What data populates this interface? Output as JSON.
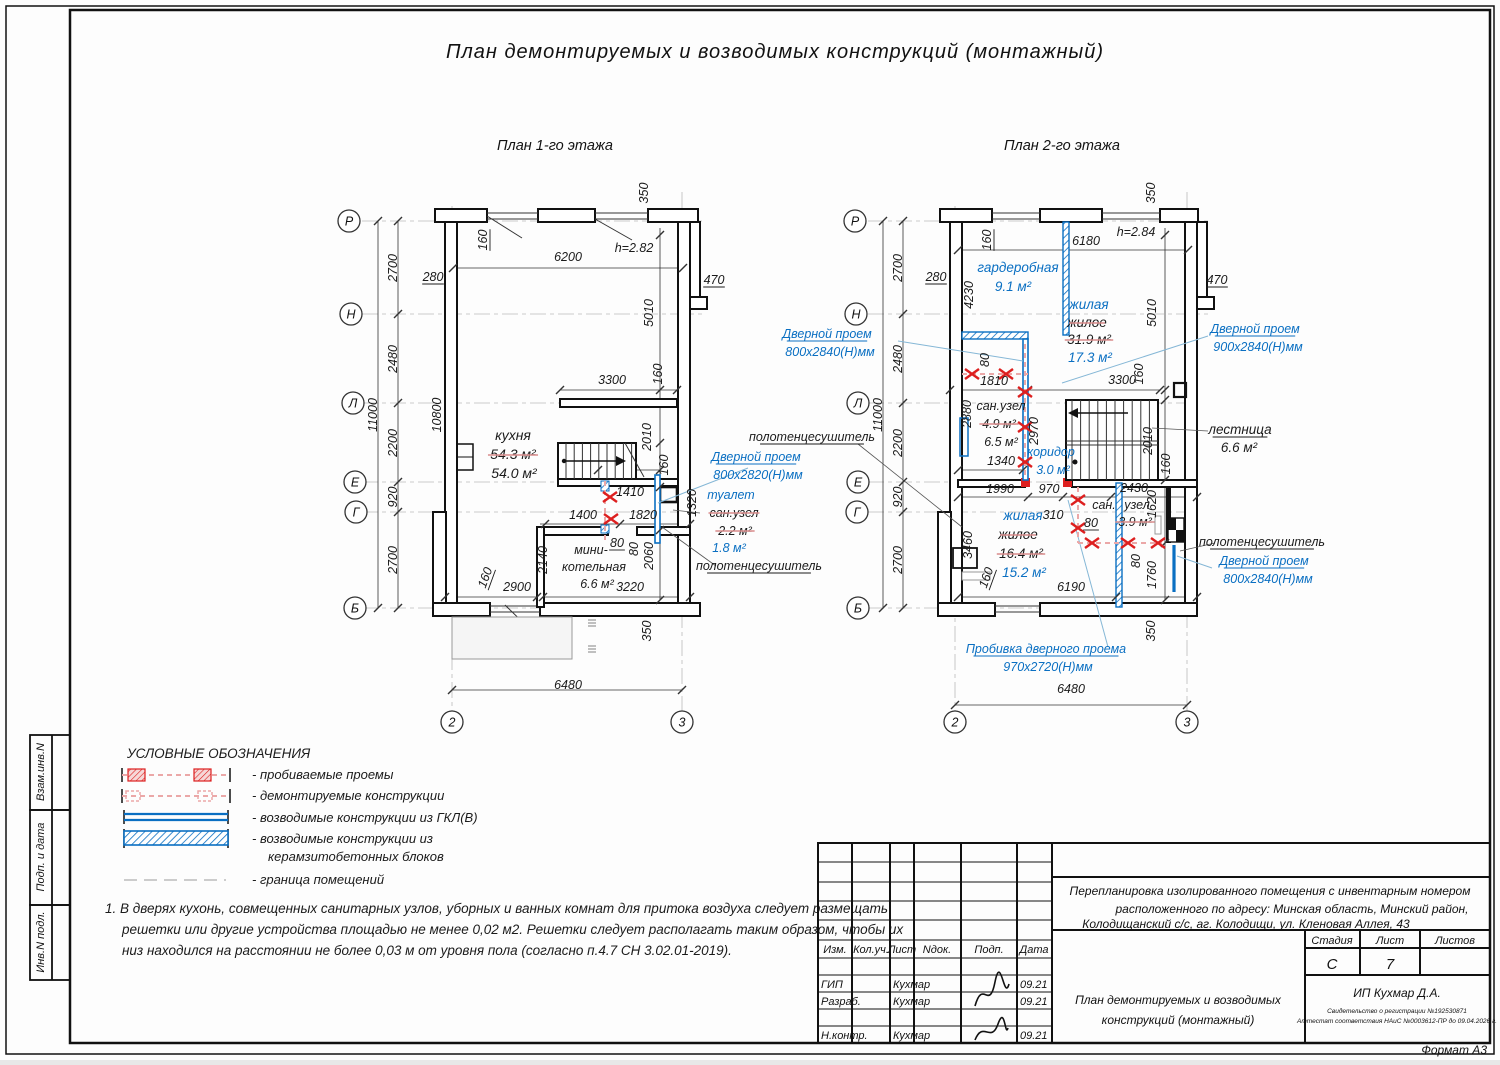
{
  "title": "План демонтируемых и возводимых конструкций (монтажный)",
  "colors": {
    "accent_blue": "#0a6fc2",
    "mark_red": "#dd1f1f",
    "strike_pink": "#d98b8b"
  },
  "plan1": {
    "subtitle": "План 1-го этажа",
    "axes": [
      {
        "t": "Р",
        "x": 349,
        "y": 221
      },
      {
        "t": "Н",
        "x": 351,
        "y": 314
      },
      {
        "t": "Л",
        "x": 353,
        "y": 403
      },
      {
        "t": "Е",
        "x": 355,
        "y": 482
      },
      {
        "t": "Г",
        "x": 356,
        "y": 512
      },
      {
        "t": "Б",
        "x": 355,
        "y": 608
      },
      {
        "t": "2",
        "x": 452,
        "y": 722
      },
      {
        "t": "3",
        "x": 682,
        "y": 722
      }
    ],
    "labels": [
      {
        "t": "350",
        "x": 648,
        "y": 193,
        "r": -90
      },
      {
        "t": "160",
        "x": 487,
        "y": 240,
        "r": -90,
        "u": 1
      },
      {
        "t": "6200",
        "x": 568,
        "y": 261
      },
      {
        "t": "h=2.82",
        "x": 634,
        "y": 252
      },
      {
        "t": "280",
        "x": 433,
        "y": 281,
        "u": 1
      },
      {
        "t": "470",
        "x": 714,
        "y": 284,
        "u": 1
      },
      {
        "t": "2700",
        "x": 397,
        "y": 268,
        "r": -90
      },
      {
        "t": "2480",
        "x": 397,
        "y": 359,
        "r": -90
      },
      {
        "t": "11000",
        "x": 377,
        "y": 415,
        "r": -90
      },
      {
        "t": "2200",
        "x": 397,
        "y": 443,
        "r": -90
      },
      {
        "t": "920",
        "x": 397,
        "y": 497,
        "r": -90
      },
      {
        "t": "2700",
        "x": 397,
        "y": 560,
        "r": -90
      },
      {
        "t": "5010",
        "x": 653,
        "y": 313,
        "r": -90
      },
      {
        "t": "10800",
        "x": 441,
        "y": 415,
        "r": -90
      },
      {
        "t": "3300",
        "x": 612,
        "y": 384
      },
      {
        "t": "160",
        "x": 662,
        "y": 374,
        "r": -90
      },
      {
        "t": "кухня",
        "x": 513,
        "y": 440,
        "fs": 14
      },
      {
        "t": "54.3 м²",
        "x": 513,
        "y": 459,
        "s": 1,
        "fs": 14
      },
      {
        "t": "54.0 м²",
        "x": 514,
        "y": 478,
        "fs": 14
      },
      {
        "t": "2010",
        "x": 651,
        "y": 437,
        "r": -90
      },
      {
        "t": "160",
        "x": 668,
        "y": 465,
        "r": -90
      },
      {
        "t": "1410",
        "x": 630,
        "y": 496
      },
      {
        "t": "1400",
        "x": 583,
        "y": 519
      },
      {
        "t": "1820",
        "x": 643,
        "y": 519
      },
      {
        "t": "1320",
        "x": 696,
        "y": 503,
        "r": -90
      },
      {
        "t": "80",
        "x": 617,
        "y": 547,
        "u": 1
      },
      {
        "t": "80",
        "x": 638,
        "y": 549,
        "r": -90
      },
      {
        "t": "2140",
        "x": 547,
        "y": 560,
        "r": -90
      },
      {
        "t": "2060",
        "x": 653,
        "y": 556,
        "r": -90
      },
      {
        "t": "мини-",
        "x": 591,
        "y": 554
      },
      {
        "t": "котельная",
        "x": 594,
        "y": 571
      },
      {
        "t": "6.6 м²",
        "x": 597,
        "y": 588
      },
      {
        "t": "3220",
        "x": 630,
        "y": 591
      },
      {
        "t": "2900",
        "x": 517,
        "y": 591
      },
      {
        "t": "160",
        "x": 489,
        "y": 579,
        "r": -70,
        "u": 1
      },
      {
        "t": "350",
        "x": 651,
        "y": 631,
        "r": -90
      },
      {
        "t": "6480",
        "x": 568,
        "y": 689
      },
      {
        "t": "Дверной проем",
        "x": 756,
        "y": 461,
        "c": "b",
        "u": 1
      },
      {
        "t": "800x2820(Н)мм",
        "x": 758,
        "y": 479,
        "c": "b"
      },
      {
        "t": "туалет",
        "x": 731,
        "y": 499,
        "c": "b"
      },
      {
        "t": "сан.узел",
        "x": 734,
        "y": 517,
        "s": 1
      },
      {
        "t": "2.2 м²",
        "x": 735,
        "y": 535,
        "s": 1
      },
      {
        "t": "1.8 м²",
        "x": 729,
        "y": 552,
        "c": "b"
      },
      {
        "t": "полотенцесушитель",
        "x": 759,
        "y": 570,
        "u": 1
      }
    ]
  },
  "plan2": {
    "subtitle": "План 2-го этажа",
    "axes": [
      {
        "t": "Р",
        "x": 855,
        "y": 221
      },
      {
        "t": "Н",
        "x": 856,
        "y": 314
      },
      {
        "t": "Л",
        "x": 858,
        "y": 403
      },
      {
        "t": "Е",
        "x": 858,
        "y": 482
      },
      {
        "t": "Г",
        "x": 857,
        "y": 512
      },
      {
        "t": "Б",
        "x": 858,
        "y": 608
      },
      {
        "t": "2",
        "x": 955,
        "y": 722
      },
      {
        "t": "3",
        "x": 1187,
        "y": 722
      }
    ],
    "labels": [
      {
        "t": "350",
        "x": 1155,
        "y": 193,
        "r": -90
      },
      {
        "t": "160",
        "x": 991,
        "y": 240,
        "r": -90,
        "u": 1
      },
      {
        "t": "6180",
        "x": 1086,
        "y": 245
      },
      {
        "t": "h=2.84",
        "x": 1136,
        "y": 236
      },
      {
        "t": "280",
        "x": 936,
        "y": 281,
        "u": 1
      },
      {
        "t": "470",
        "x": 1217,
        "y": 284,
        "u": 1
      },
      {
        "t": "2700",
        "x": 902,
        "y": 268,
        "r": -90
      },
      {
        "t": "2480",
        "x": 902,
        "y": 359,
        "r": -90
      },
      {
        "t": "11000",
        "x": 882,
        "y": 415,
        "r": -90
      },
      {
        "t": "2200",
        "x": 902,
        "y": 443,
        "r": -90
      },
      {
        "t": "920",
        "x": 902,
        "y": 497,
        "r": -90
      },
      {
        "t": "2700",
        "x": 902,
        "y": 560,
        "r": -90
      },
      {
        "t": "гардеробная",
        "x": 1018,
        "y": 272,
        "c": "b",
        "fs": 13.5
      },
      {
        "t": "9.1 м²",
        "x": 1013,
        "y": 291,
        "c": "b",
        "fs": 13.5
      },
      {
        "t": "4230",
        "x": 973,
        "y": 295,
        "r": -90
      },
      {
        "t": "5010",
        "x": 1156,
        "y": 313,
        "r": -90
      },
      {
        "t": "жилая",
        "x": 1089,
        "y": 309,
        "c": "b",
        "fs": 13.5
      },
      {
        "t": "жилое",
        "x": 1087,
        "y": 327,
        "s": 1,
        "fs": 13.5
      },
      {
        "t": "31.9 м²",
        "x": 1089,
        "y": 344,
        "s": 1,
        "fs": 13.5
      },
      {
        "t": "17.3 м²",
        "x": 1090,
        "y": 362,
        "c": "b",
        "fs": 13.5
      },
      {
        "t": "Дверной проем",
        "x": 827,
        "y": 338,
        "c": "b",
        "u": 1
      },
      {
        "t": "800x2840(Н)мм",
        "x": 830,
        "y": 356,
        "c": "b"
      },
      {
        "t": "полотенцесушитель",
        "x": 812,
        "y": 441,
        "u": 1
      },
      {
        "t": "80",
        "x": 989,
        "y": 360,
        "r": -90
      },
      {
        "t": "1810",
        "x": 994,
        "y": 385
      },
      {
        "t": "2880",
        "x": 971,
        "y": 414,
        "r": -90
      },
      {
        "t": "сан.узел",
        "x": 1001,
        "y": 410
      },
      {
        "t": "4.9 м²",
        "x": 999,
        "y": 428,
        "s": 1
      },
      {
        "t": "6.5 м²",
        "x": 1001,
        "y": 446
      },
      {
        "t": "2970",
        "x": 1038,
        "y": 431,
        "r": -90
      },
      {
        "t": "коридор",
        "x": 1051,
        "y": 456,
        "c": "b"
      },
      {
        "t": "3.0 м²",
        "x": 1053,
        "y": 474,
        "c": "b"
      },
      {
        "t": "1340",
        "x": 1001,
        "y": 465
      },
      {
        "t": "3300",
        "x": 1122,
        "y": 384
      },
      {
        "t": "160",
        "x": 1143,
        "y": 374,
        "r": -90
      },
      {
        "t": "2010",
        "x": 1152,
        "y": 441,
        "r": -90
      },
      {
        "t": "160",
        "x": 1170,
        "y": 464,
        "r": -90
      },
      {
        "t": "лестница",
        "x": 1240,
        "y": 434,
        "u": 1,
        "fs": 13.5
      },
      {
        "t": "6.6 м²",
        "x": 1239,
        "y": 452,
        "fs": 13.5
      },
      {
        "t": "Дверной проем",
        "x": 1255,
        "y": 333,
        "c": "b",
        "u": 1
      },
      {
        "t": "900x2840(Н)мм",
        "x": 1258,
        "y": 351,
        "c": "b"
      },
      {
        "t": "1990",
        "x": 1000,
        "y": 493
      },
      {
        "t": "970",
        "x": 1049,
        "y": 493
      },
      {
        "t": "2430",
        "x": 1134,
        "y": 492
      },
      {
        "t": "1620",
        "x": 1156,
        "y": 504,
        "r": -90
      },
      {
        "t": "сан.",
        "x": 1104,
        "y": 509
      },
      {
        "t": "узел",
        "x": 1137,
        "y": 509
      },
      {
        "t": "310",
        "x": 1053,
        "y": 519
      },
      {
        "t": "80",
        "x": 1091,
        "y": 527,
        "u": 1
      },
      {
        "t": "3.9 м²",
        "x": 1135,
        "y": 526,
        "s": 1
      },
      {
        "t": "жилая",
        "x": 1023,
        "y": 520,
        "c": "b",
        "fs": 13.5
      },
      {
        "t": "жилое",
        "x": 1018,
        "y": 539,
        "s": 1,
        "fs": 13.5
      },
      {
        "t": "16.4 м²",
        "x": 1021,
        "y": 558,
        "s": 1,
        "fs": 13.5
      },
      {
        "t": "15.2 м²",
        "x": 1024,
        "y": 577,
        "c": "b",
        "fs": 13.5
      },
      {
        "t": "3460",
        "x": 972,
        "y": 545,
        "r": -90
      },
      {
        "t": "160",
        "x": 990,
        "y": 579,
        "r": -70,
        "u": 1
      },
      {
        "t": "6190",
        "x": 1071,
        "y": 591
      },
      {
        "t": "80",
        "x": 1140,
        "y": 561,
        "r": -90
      },
      {
        "t": "1760",
        "x": 1156,
        "y": 575,
        "r": -90
      },
      {
        "t": "полотенцесушитель",
        "x": 1262,
        "y": 546,
        "u": 1
      },
      {
        "t": "Дверной проем",
        "x": 1264,
        "y": 565,
        "c": "b",
        "u": 1
      },
      {
        "t": "800x2840(Н)мм",
        "x": 1268,
        "y": 583,
        "c": "b"
      },
      {
        "t": "350",
        "x": 1155,
        "y": 631,
        "r": -90
      },
      {
        "t": "6480",
        "x": 1071,
        "y": 693
      },
      {
        "t": "Пробивка дверного проема",
        "x": 1046,
        "y": 653,
        "c": "b",
        "u": 1
      },
      {
        "t": "970x2720(Н)мм",
        "x": 1048,
        "y": 671,
        "c": "b"
      }
    ]
  },
  "legend": {
    "heading": "УСЛОВНЫЕ ОБОЗНАЧЕНИЯ",
    "items": [
      {
        "type": "punched-openings",
        "label": "- пробиваемые проемы"
      },
      {
        "type": "demolished",
        "label": "- демонтируемые конструкции"
      },
      {
        "type": "gkl",
        "label": "- возводимые конструкции из ГКЛ(В)"
      },
      {
        "type": "blocks",
        "label": "- возводимые конструкции из",
        "label2": "керамзитобетонных блоков"
      },
      {
        "type": "boundary",
        "label": "- граница помещений"
      }
    ]
  },
  "notes": [
    "1. В дверях кухонь, совмещенных санитарных узлов, уборных и ванных комнат для притока воздуха следует размещать",
    "решетки или другие устройства площадью не менее 0,02 м2. Решетки следует располагать таким образом, чтобы их",
    "низ находился на расстоянии не более 0,03 м от уровня пола  (согласно п.4.7 СН 3.02.01-2019)."
  ],
  "sidebar": {
    "labels": [
      "Взам.инв.N",
      "Подп. и дата",
      "Инв.N подл."
    ]
  },
  "titleblock": {
    "columns": [
      "Изм.",
      "Кол.уч.",
      "Лист",
      "Nдок.",
      "Подп.",
      "Дата"
    ],
    "rows": [
      {
        "role": "ГИП",
        "name": "Кухмар",
        "date": "09.21"
      },
      {
        "role": "Разраб.",
        "name": "Кухмар",
        "date": "09.21"
      },
      {
        "role": "Н.контр.",
        "name": "Кухмар",
        "date": "09.21"
      }
    ],
    "project1": "Перепланировка изолированного помещения с инвентарным номером",
    "project2": "расположенного по адресу: Минская область, Минский район,",
    "project3": "Колодищанский с/с, аг. Колодищи, ул. Кленовая Аллея, 43",
    "stage_label": "Стадия",
    "sheet_label": "Лист",
    "sheets_label": "Листов",
    "stage": "С",
    "sheet": "7",
    "sheets": "",
    "doc_title1": "План демонтируемых и возводимых",
    "doc_title2": "конструкций (монтажный)",
    "company": "ИП Кухмар Д.А.",
    "cert1": "Свидетельство о регистрации №192530871",
    "cert2": "Аттестат соответствия НАиС №0003612-ПР до 09.04.2026 г.",
    "format": "Формат А3"
  }
}
